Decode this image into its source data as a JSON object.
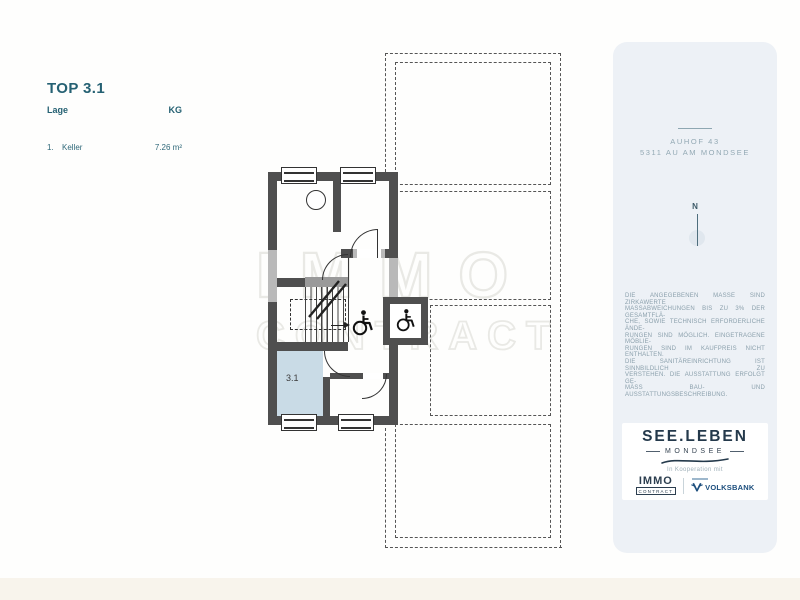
{
  "unit_info": {
    "title": "TOP 3.1",
    "location_header": "Lage",
    "level_header": "KG",
    "rows": [
      {
        "index": "1.",
        "name": "Keller",
        "area": "7.26 m²"
      }
    ]
  },
  "floor_plan": {
    "room_label": "3.1",
    "wall_color": "#4f4f4f",
    "highlight_room_fill": "#c9dbe6",
    "icon_names": [
      "wheelchair-icon",
      "elevator-wheelchair-icon",
      "stairs",
      "window-symbol",
      "door-arc"
    ]
  },
  "watermark": {
    "line1": "IMMO",
    "line2": "CONTRACT"
  },
  "side_panel": {
    "background": "#edf1f6",
    "address": {
      "line1": "AUHOF 43",
      "line2": "5311 AU AM MONDSEE"
    },
    "compass_label": "N",
    "disclaimer_lines": [
      "DIE ANGEGEBENEN MASSE SIND ZIRKAWERTE",
      "MASSABWEICHUNGEN BIS ZU 3% DER GESAMTFLÄ-",
      "CHE, SOWIE TECHNISCH ERFORDERLICHE ÄNDE-",
      "RUNGEN SIND MÖGLICH. EINGETRAGENE MÖBLIE-",
      "RUNGEN SIND IM KAUFPREIS NICHT ENTHALTEN.",
      "DIE SANITÄREINRICHTUNG IST SINNBILDLICH ZU",
      "VERSTEHEN. DIE AUSSTATTUNG ERFOLGT GE-",
      "MÄSS BAU- UND AUSSTATTUNGSBESCHREIBUNG."
    ],
    "logo_card": {
      "brand": "SEE.LEBEN",
      "brand_sub": "MONDSEE",
      "cooperation_text": "In Kooperation mit",
      "partner_immo_top": "IMMO",
      "partner_immo_bottom": "CONTRACT",
      "partner_bank": "VOLKSBANK"
    }
  },
  "colors": {
    "accent_teal": "#256173",
    "logo_navy": "#24394b",
    "volksbank_blue": "#1c4e7d"
  }
}
